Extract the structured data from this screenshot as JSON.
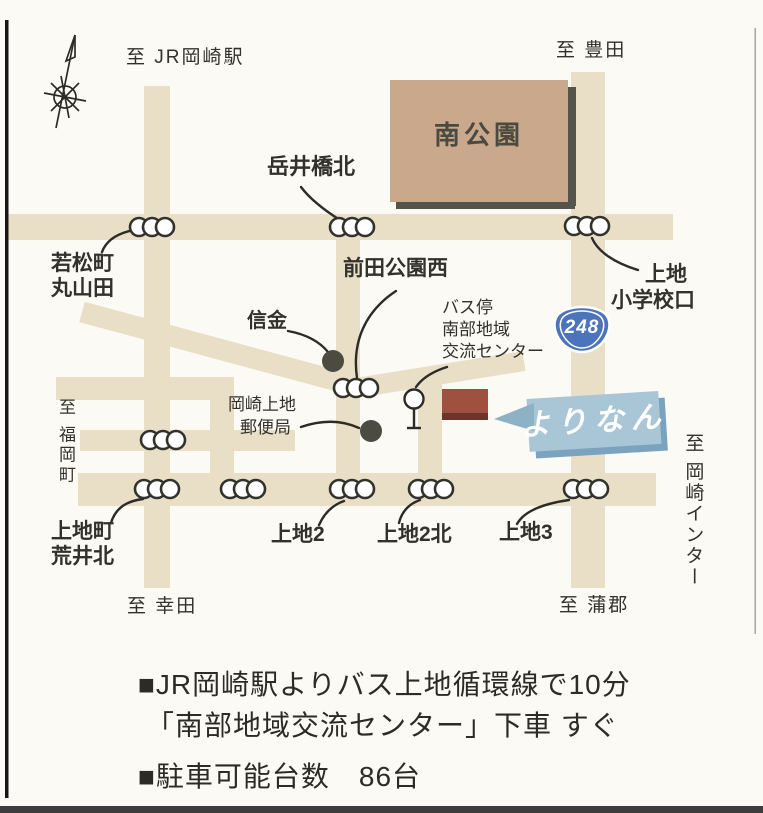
{
  "map": {
    "edge_labels": {
      "to_jr_okazaki": "至 JR岡崎駅",
      "to_toyota": "至 豊田",
      "to_fukuoka": "至 福岡町",
      "to_okazaki_ic": "至 岡崎インター",
      "to_kota": "至 幸田",
      "to_gamagori": "至 蒲郡"
    },
    "park": {
      "name": "南公園"
    },
    "route_badge": {
      "number": "248"
    },
    "intersections": {
      "takeibashi_kita": "岳井橋北",
      "wakamatsu_line1": "若松町",
      "wakamatsu_line2": "丸山田",
      "maeda_koen_nishi": "前田公園西",
      "ueji_elem_line1": "上地",
      "ueji_elem_line2": "小学校口",
      "uejicho_line1": "上地町",
      "uejicho_line2": "荒井北",
      "ueji2": "上地2",
      "ueji2_kita": "上地2北",
      "ueji3": "上地3"
    },
    "landmarks": {
      "shinkin": "信金",
      "post_office_line1": "岡崎上地",
      "post_office_line2": "郵便局",
      "bus_stop_line1": "バス停",
      "bus_stop_line2": "南部地域",
      "bus_stop_line3": "交流センター",
      "facility_name": "よりなん"
    },
    "colors": {
      "road": "#e9dfc6",
      "park": "#c9a88b",
      "park_shadow": "#54544a",
      "route_badge_blue": "#4c74ba",
      "banner_blue": "#a9c6d7",
      "banner_shadow": "#7ba3bf",
      "banner_tail": "#8db1c5",
      "building_red": "#a0503e",
      "ink": "#2c2b26"
    }
  },
  "notes": {
    "access_line1": "■JR岡崎駅よりバス上地循環線で10分",
    "access_line2": "「南部地域交流センター」下車 すぐ",
    "parking": "■駐車可能台数　86台"
  }
}
